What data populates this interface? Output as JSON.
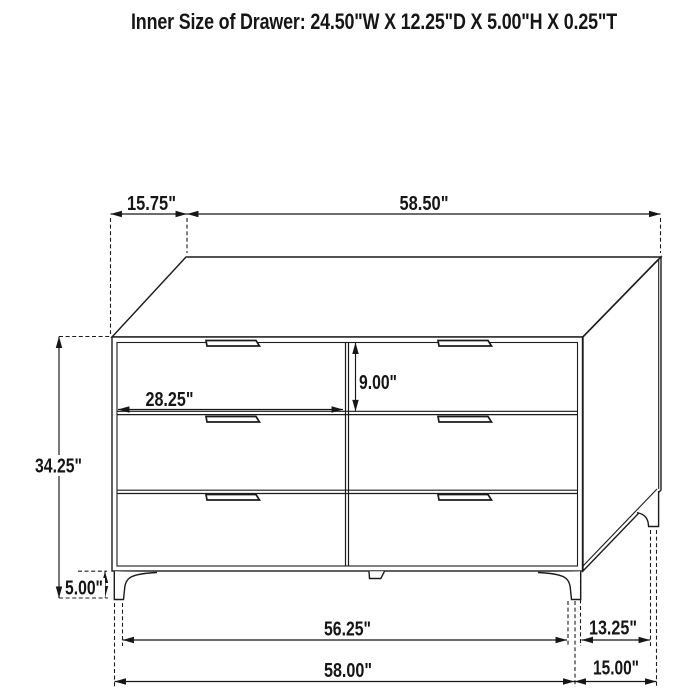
{
  "title": "Inner Size of Drawer: 24.50\"W X 12.25\"D X 5.00\"H X 0.25\"T",
  "diagram_type": "furniture-dimension-drawing",
  "subject": "6-drawer dresser",
  "colors": {
    "ink": "#1c1c1c",
    "background": "#ffffff"
  },
  "dims": {
    "top_depth": "15.75\"",
    "top_width": "58.50\"",
    "drawer_face_width": "28.25\"",
    "drawer_face_height": "9.00\"",
    "cabinet_height": "34.25\"",
    "leg_height": "5.00\"",
    "front_leg_span": "56.25\"",
    "overall_width": "58.00\"",
    "side_leg_span": "13.25\"",
    "overall_depth": "15.00\""
  }
}
